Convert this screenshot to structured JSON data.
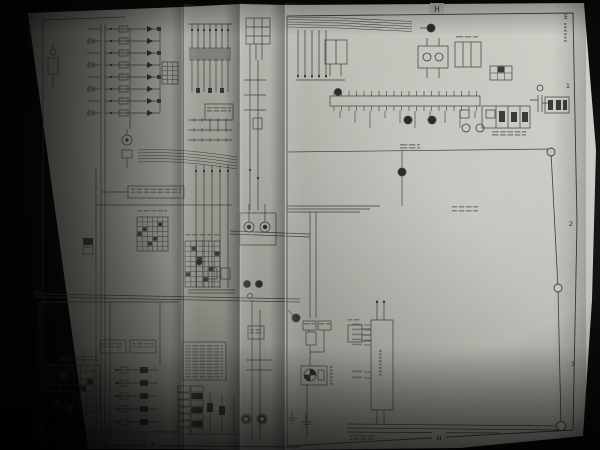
{
  "scene": {
    "type": "photograph",
    "subject": "Service-manual automotive wiring diagram foldout pages photographed on a black background",
    "background_color": "#0a0a09",
    "paper_tone_bright": "#d5d4cd",
    "paper_tone_shadow": "#67665f",
    "ink_color": "#3e3f3a"
  },
  "page": {
    "markers": {
      "top_center": "H",
      "bottom_center": "H",
      "bottom_left": "A",
      "right_zone_1": "1",
      "right_zone_2": "2",
      "right_zone_3": "3",
      "top_right_corner": "E",
      "top_left_corner": "E"
    }
  },
  "diagram": {
    "kind": "automotive wiring schematic (multi-sheet foldout)",
    "features": [
      "connector rows",
      "fuse and relay symbols",
      "pin-grid connector tables",
      "wire bundles crossing page folds",
      "ECU block with pin stubs",
      "bulb and ground symbols",
      "registration circles on page border"
    ]
  }
}
